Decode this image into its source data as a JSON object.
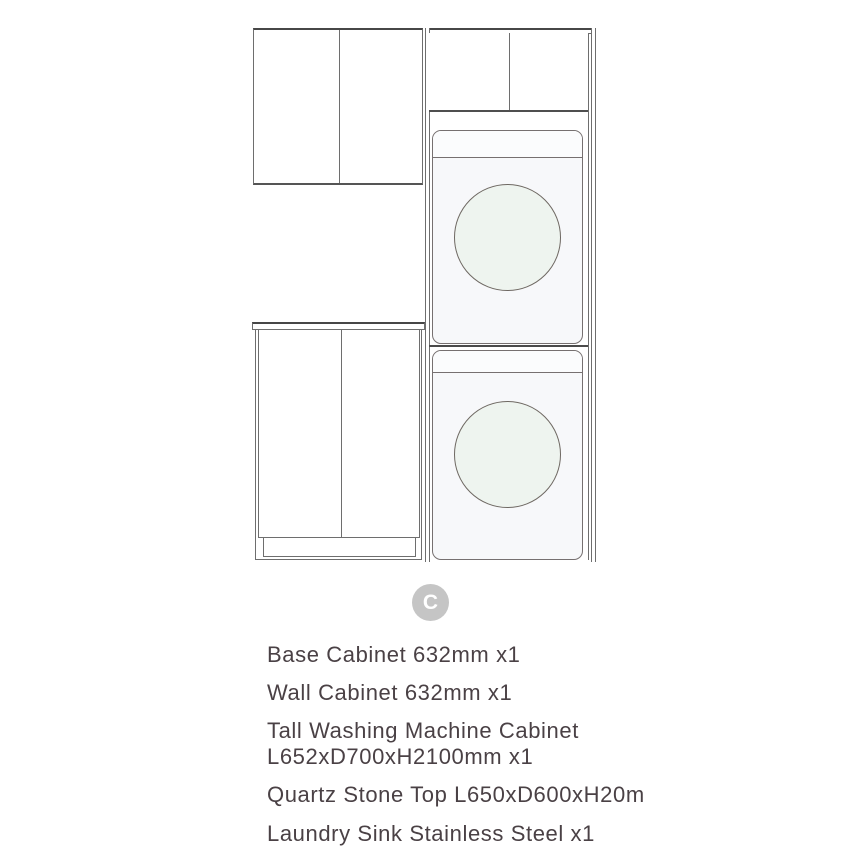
{
  "badge": {
    "label": "C"
  },
  "product_list": {
    "items": [
      {
        "name": "base-cabinet",
        "lines": [
          "Base Cabinet 632mm x1"
        ]
      },
      {
        "name": "wall-cabinet",
        "lines": [
          "Wall Cabinet 632mm x1"
        ]
      },
      {
        "name": "tall-washing-machine-cabinet",
        "lines": [
          "Tall Washing Machine Cabinet",
          "L652xD700xH2100mm x1"
        ]
      },
      {
        "name": "quartz-stone-top",
        "lines": [
          "Quartz Stone Top L650xD600xH20m"
        ]
      },
      {
        "name": "laundry-sink",
        "lines": [
          "Laundry Sink Stainless Steel x1"
        ]
      }
    ]
  },
  "diagram": {
    "components": [
      "wall-cabinet-two-doors",
      "base-cabinet-two-doors-with-kickboard",
      "quartz-stone-counter-top",
      "tall-cabinet-with-top-doors",
      "washing-machine-upper",
      "washing-machine-lower"
    ],
    "colors": {
      "background": "#ffffff",
      "line": "#6e6e6e",
      "line_strong": "#474747",
      "washer_body": "#f7f8fa",
      "drum_fill": "#eef4ef",
      "drum_stroke": "#6e6862",
      "badge_bg": "#c5c5c5",
      "badge_text": "#ffffff",
      "text": "#4a4145"
    }
  }
}
